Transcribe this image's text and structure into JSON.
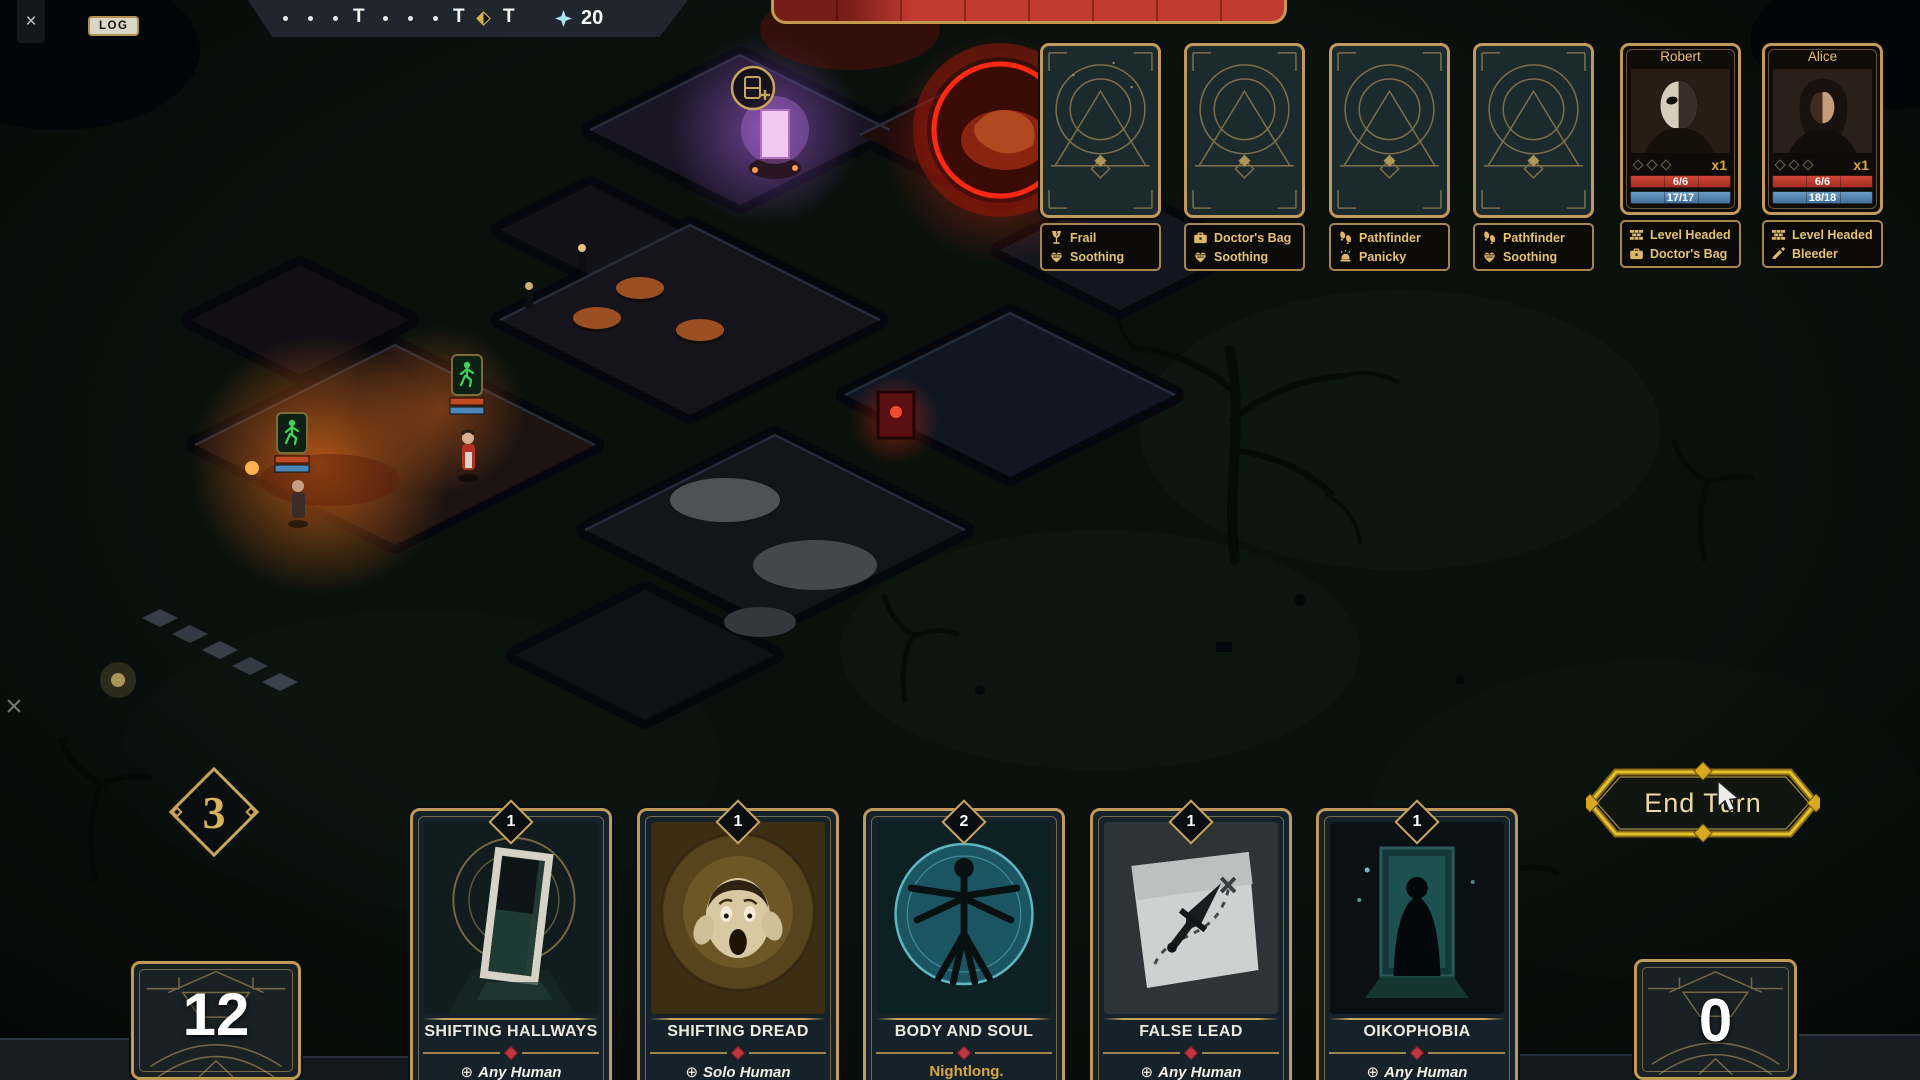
{
  "window": {
    "close_icon": "×",
    "log_label": "LOG"
  },
  "timeline": {
    "t_label": "T",
    "resource_value": "20"
  },
  "trap_cards": [
    {
      "traits": [
        {
          "icon": "fragile-icon",
          "label": "Frail"
        },
        {
          "icon": "soothing-icon",
          "label": "Soothing"
        }
      ]
    },
    {
      "traits": [
        {
          "icon": "doctors-bag-icon",
          "label": "Doctor's Bag"
        },
        {
          "icon": "soothing-icon",
          "label": "Soothing"
        }
      ]
    },
    {
      "traits": [
        {
          "icon": "pathfinder-icon",
          "label": "Pathfinder"
        },
        {
          "icon": "panicky-icon",
          "label": "Panicky"
        }
      ]
    },
    {
      "traits": [
        {
          "icon": "pathfinder-icon",
          "label": "Pathfinder"
        },
        {
          "icon": "soothing-icon",
          "label": "Soothing"
        }
      ]
    }
  ],
  "characters": [
    {
      "name": "Robert",
      "multiplier": "x1",
      "hp": "6/6",
      "sanity": "17/17",
      "traits": [
        {
          "icon": "level-headed-icon",
          "label": "Level Headed"
        },
        {
          "icon": "doctors-bag-icon",
          "label": "Doctor's Bag"
        }
      ]
    },
    {
      "name": "Alice",
      "multiplier": "x1",
      "hp": "6/6",
      "sanity": "18/18",
      "traits": [
        {
          "icon": "level-headed-icon",
          "label": "Level Headed"
        },
        {
          "icon": "bleeder-icon",
          "label": "Bleeder"
        }
      ]
    }
  ],
  "hand": {
    "plays_left": "3",
    "cards": [
      {
        "cost": "1",
        "title": "SHIFTING HALLWAYS",
        "target": "Any Human",
        "target_icon": "⊕"
      },
      {
        "cost": "1",
        "title": "SHIFTING DREAD",
        "target": "Solo Human",
        "target_icon": "⊕"
      },
      {
        "cost": "2",
        "title": "BODY AND SOUL",
        "target": "Nightlong.",
        "target_icon": ""
      },
      {
        "cost": "1",
        "title": "FALSE LEAD",
        "target": "Any Human",
        "target_icon": "⊕"
      },
      {
        "cost": "1",
        "title": "OIKOPHOBIA",
        "target": "Any Human",
        "target_icon": "⊕"
      }
    ]
  },
  "decks": {
    "draw_count": "12",
    "discard_count": "0"
  },
  "end_turn": {
    "label": "End Turn"
  },
  "colors": {
    "gold": "#c9a55a",
    "red": "#c23a30",
    "blue": "#4f86b8",
    "green": "#42d458"
  }
}
